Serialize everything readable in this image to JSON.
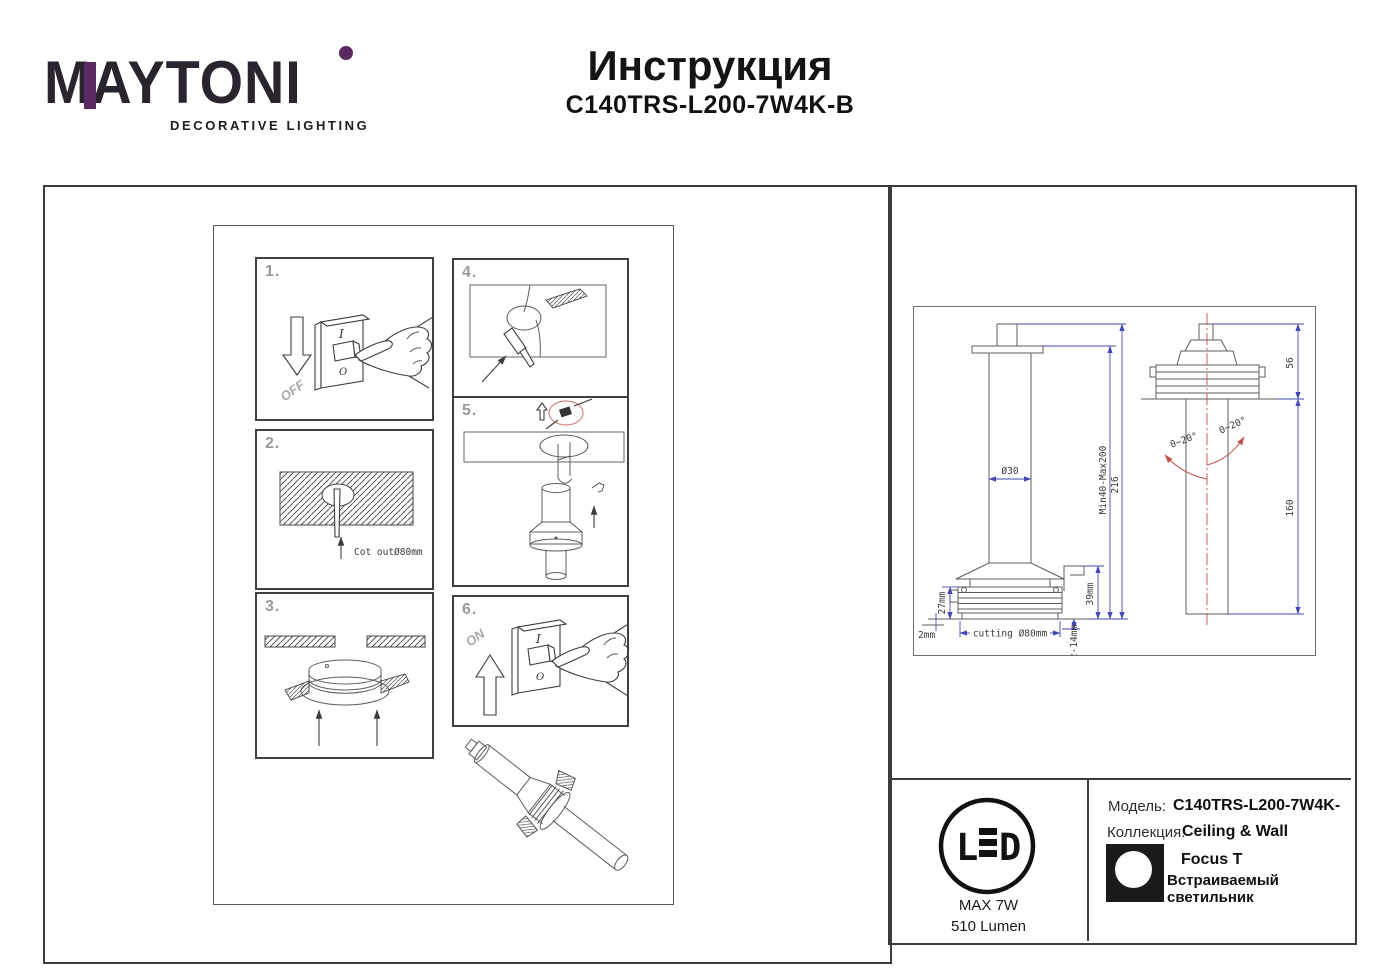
{
  "logo": {
    "brand": "MAYTONI",
    "tagline": "DECORATIVE LIGHTING"
  },
  "header": {
    "title": "Инструкция",
    "model": "C140TRS-L200-7W4K-B"
  },
  "steps": {
    "s1": {
      "num": "1.",
      "off": "OFF",
      "sw_top": "I",
      "sw_bottom": "O"
    },
    "s2": {
      "num": "2.",
      "cutout": "Cot outØ80mm"
    },
    "s3": {
      "num": "3."
    },
    "s4": {
      "num": "4."
    },
    "s5": {
      "num": "5."
    },
    "s6": {
      "num": "6.",
      "on": "ON",
      "sw_top": "I",
      "sw_bottom": "O"
    }
  },
  "drawing": {
    "dims": {
      "shaft_dia": "Ø30",
      "rod_range": "Min40-Max200",
      "total_h": "216",
      "ring_h": "27mm",
      "panel": "2mm",
      "cutting": "cutting Ø80mm",
      "recess": "39mm",
      "clamp_range": "2-14mm",
      "head_h": "56",
      "drop_len": "160",
      "angle_left": "0~20°",
      "angle_right": "0~20°"
    }
  },
  "info": {
    "led": {
      "letter_l": "L",
      "letter_d": "D",
      "max_power": "MAX 7W",
      "lumen": "510 Lumen"
    },
    "model_label": "Модель:",
    "model_value": "C140TRS-L200-7W4K-",
    "collection_label": "Коллекция:",
    "collection_value": "Ceiling & Wall",
    "product_name": "Focus T",
    "product_type": "Встраиваемый светильник"
  },
  "colors": {
    "accent_purple": "#5b2a60",
    "dim_blue": "#4646b4",
    "mark_red": "#c2504b"
  }
}
